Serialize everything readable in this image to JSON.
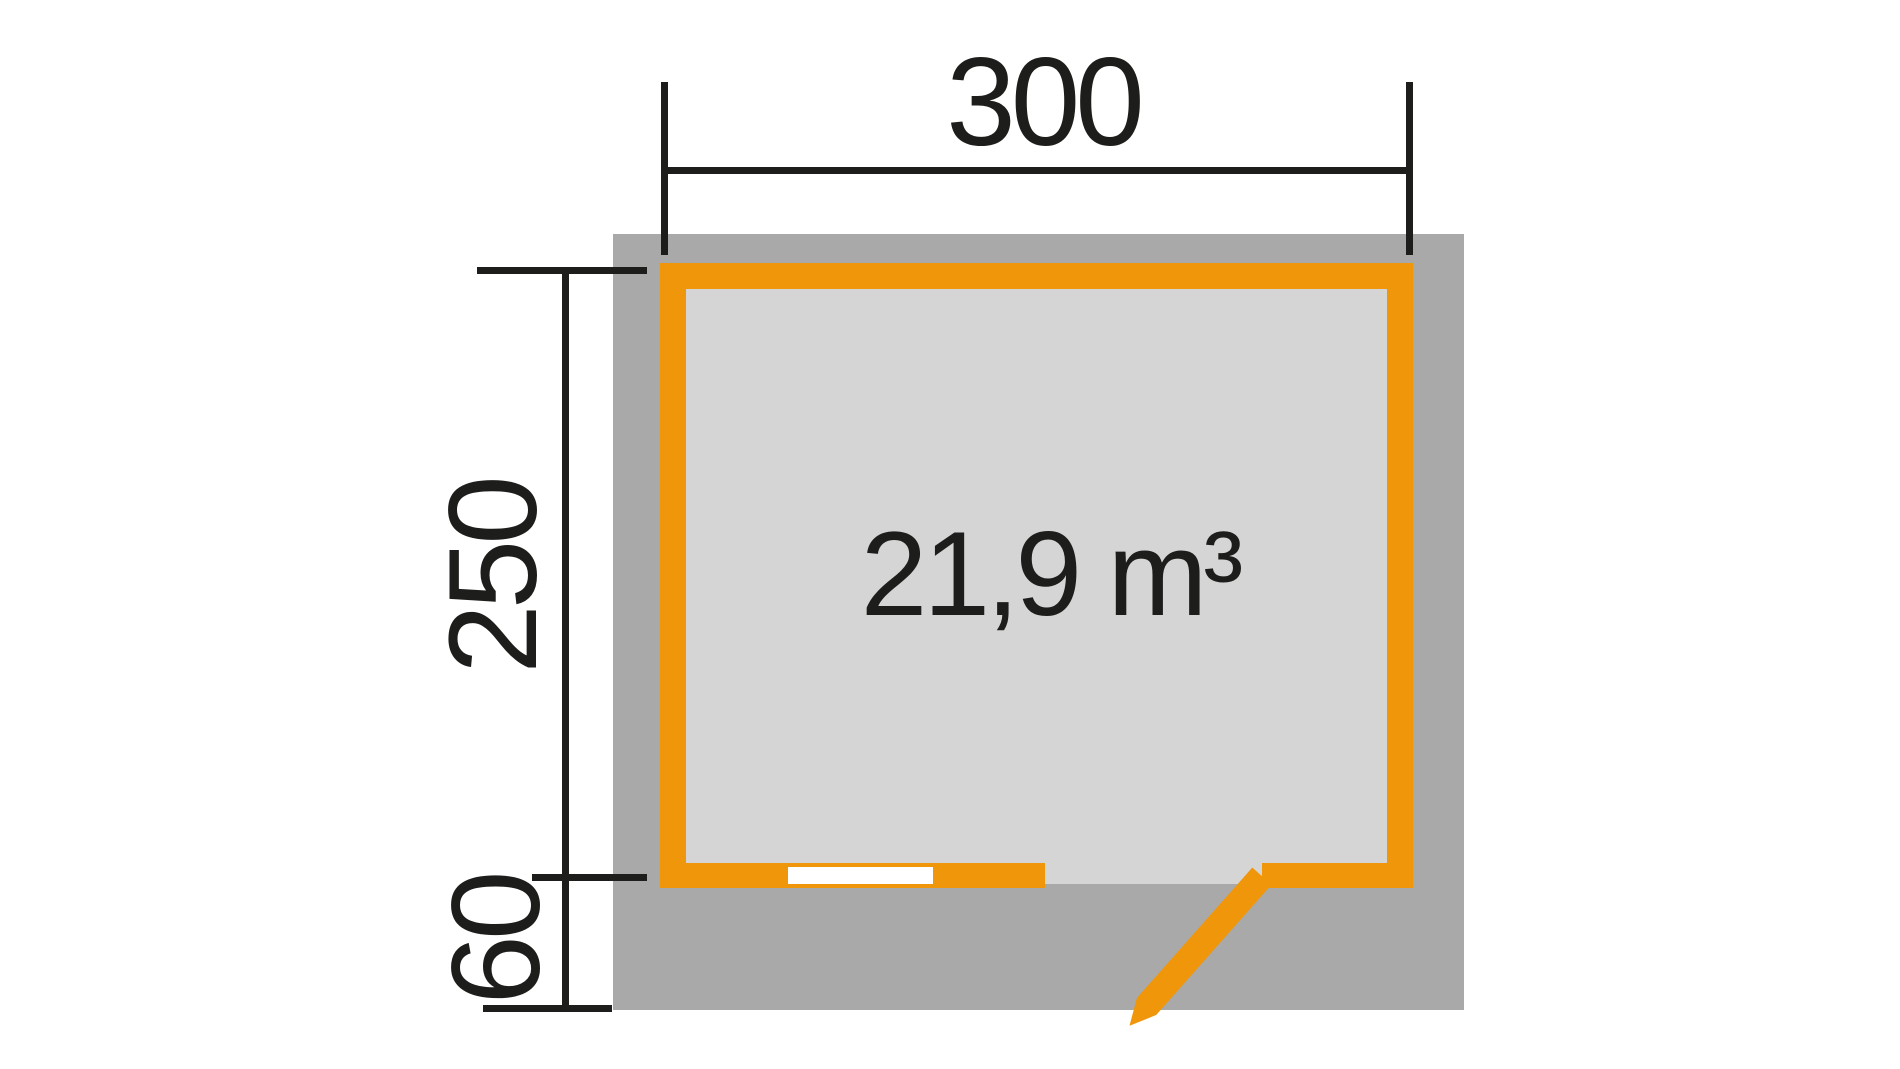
{
  "plan": {
    "volume_label": "21,9 m³",
    "dimensions": {
      "width_label": "300",
      "depth_label": "250",
      "overhang_label": "60"
    }
  },
  "colors": {
    "wall_orange": "#f0960a",
    "roof_gray": "#a9a9a9",
    "floor_gray": "#d5d5d5",
    "window_white": "#ffffff",
    "ink": "#1d1d1b"
  }
}
